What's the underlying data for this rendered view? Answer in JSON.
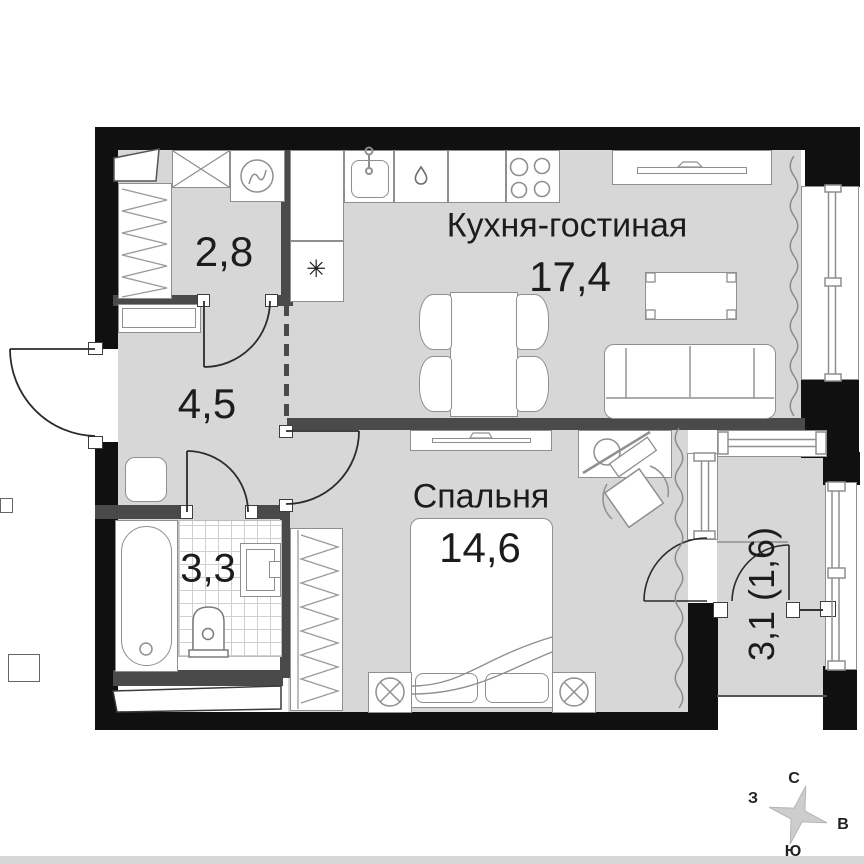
{
  "rooms": {
    "kitchen_living": {
      "name": "Кухня-гостиная",
      "area": "17,4"
    },
    "bedroom": {
      "name": "Спальня",
      "area": "14,6"
    },
    "dressing": {
      "area": "2,8"
    },
    "hallway": {
      "area": "4,5"
    },
    "bathroom": {
      "area": "3,3"
    },
    "loggia": {
      "area": "3,1 (1,6)"
    }
  },
  "compass": {
    "north": "С",
    "east": "В",
    "south": "Ю",
    "west": "З"
  },
  "symbols": {
    "fridge_snowflake": "✳"
  },
  "colors": {
    "wall": "#101010",
    "inner_wall": "#4a4a4a",
    "floor": "#d7d7d7",
    "furniture_stroke": "#8f8f8f",
    "label_text": "#1c1c1c",
    "compass_star": "#cdcdcd"
  }
}
